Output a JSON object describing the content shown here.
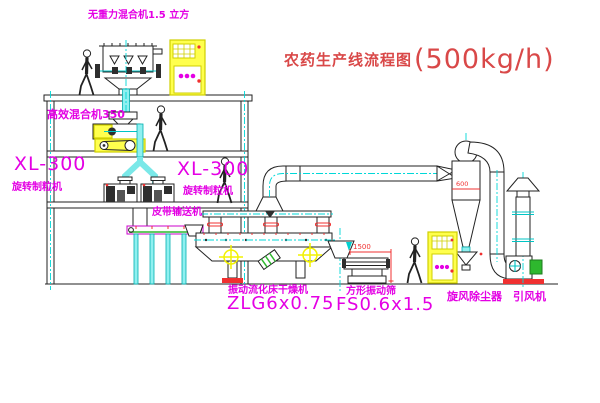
{
  "title": {
    "name": "农药生产线流程图",
    "capacity": "(500kg/h)"
  },
  "labels": {
    "top_mixer": "无重力混合机1.5 立方",
    "mixer350": "高效混合机350",
    "granulator_left_model": "XL-300",
    "granulator_left_name": "旋转制粒机",
    "granulator_right_model": "XL-300",
    "granulator_right_name": "旋转制粒机",
    "belt_conveyor": "皮带输送机",
    "dryer_name": "振动流化床干燥机",
    "dryer_model": "ZLG6x0.75",
    "screen_name": "方形振动筛",
    "screen_model": "FS0.6x1.5",
    "cyclone": "旋风除尘器",
    "fan": "引风机"
  },
  "dimensions": {
    "screen_length": "1500",
    "cyclone_diameter": "600"
  },
  "colors": {
    "label": "#e400e4",
    "title": "#d94848",
    "centerline": "#00d8d8",
    "highlight": "#ffff4d",
    "dimension": "#f03030",
    "motor_green": "#2eb82e"
  }
}
